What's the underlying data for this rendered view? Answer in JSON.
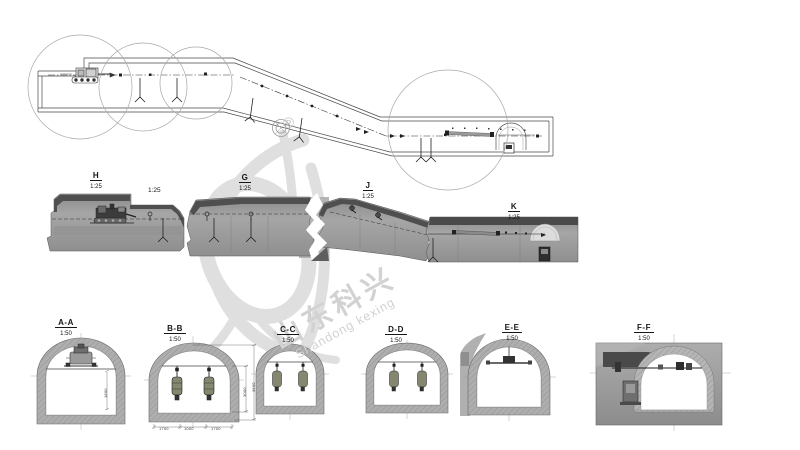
{
  "watermark": {
    "registered": "®",
    "company_cn": "山东科兴",
    "company_en": "Shandong kexing"
  },
  "detail_views": [
    {
      "name": "H",
      "scale": "1:25"
    },
    {
      "name": "G",
      "scale": "1:25"
    },
    {
      "name": "J",
      "scale": "1:25"
    },
    {
      "name": "K",
      "scale": "1:25"
    }
  ],
  "aux_scale_label": "1:25",
  "cross_sections": [
    {
      "name": "A-A",
      "scale": "1:50"
    },
    {
      "name": "B-B",
      "scale": "1:50"
    },
    {
      "name": "C-C",
      "scale": "1:50"
    },
    {
      "name": "D-D",
      "scale": "1:50"
    },
    {
      "name": "E-E",
      "scale": "1:50"
    },
    {
      "name": "F-F",
      "scale": "1:50"
    }
  ],
  "dimensions": {
    "aa_height": "1800",
    "bb_bottom_left": "1700",
    "bb_bottom_mid": "1000",
    "bb_bottom_right": "1700",
    "bb_right_inner": "3000",
    "bb_right_outer": "3500"
  },
  "colors": {
    "line": "#444444",
    "section_fill": "#9e9e9e",
    "section_top_band": "#4f4f4f",
    "ring_fill": "#aeaeae",
    "watermark": "#d6d6d6"
  }
}
